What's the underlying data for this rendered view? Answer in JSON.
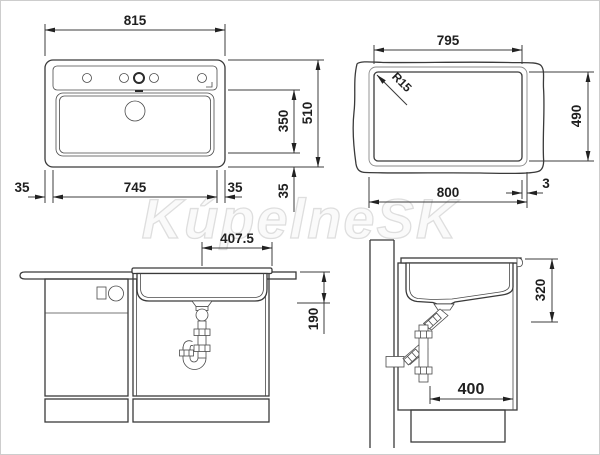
{
  "watermark": "KúpelneSK",
  "drawing": {
    "top_view": {
      "overall_width": "815",
      "basin_width": "745",
      "rim_left": "35",
      "rim_right": "35",
      "basin_front_to_back": "350",
      "overall_depth": "510",
      "rim_bottom": "35"
    },
    "cutout_view": {
      "width_top": "795",
      "corner_radius": "R15",
      "height": "490",
      "width_bottom": "800",
      "edge_offset": "3"
    },
    "front_view": {
      "drain_to_edge": "407.5",
      "basin_depth": "190"
    },
    "side_view": {
      "sink_height": "320",
      "min_cabinet_depth": "400"
    }
  }
}
